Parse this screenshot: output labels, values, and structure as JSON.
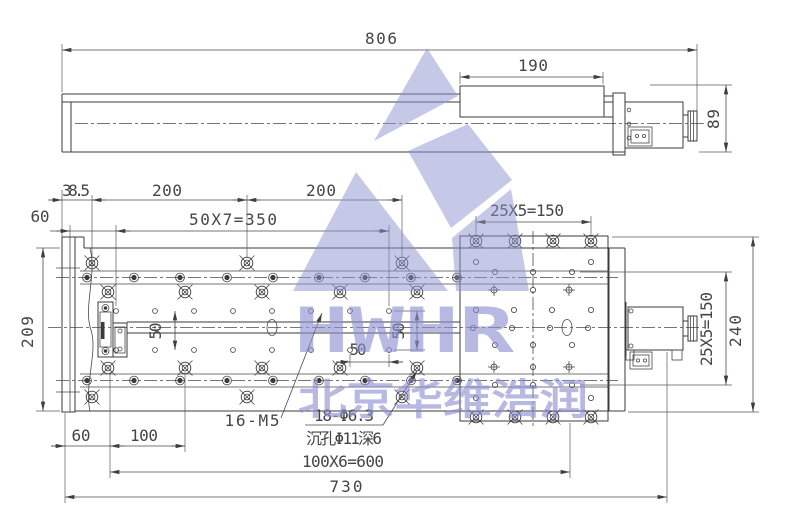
{
  "dims": {
    "d806": "806",
    "d190": "190",
    "d89": "89",
    "d38_5": "38.5",
    "d200a": "200",
    "d200b": "200",
    "d60_top": "60",
    "d50x7": "50X7=350",
    "d25x5_top": "25X5=150",
    "d209": "209",
    "d50_left": "50",
    "d50_mid_v": "50",
    "d50_mid_h": "50",
    "d60_bot": "60",
    "d100": "100",
    "d100x6": "100X6=600",
    "d730": "730",
    "d25x5_right": "25X5=150",
    "d240": "240"
  },
  "labels": {
    "m5_holes": "16-M5",
    "cb_holes": "18-Φ6.3",
    "cb_note": "沉孔Φ11深6"
  },
  "watermark": {
    "logo_text": "HWHR",
    "company_name": "北京华维浩润",
    "color": "#8e92cf"
  }
}
